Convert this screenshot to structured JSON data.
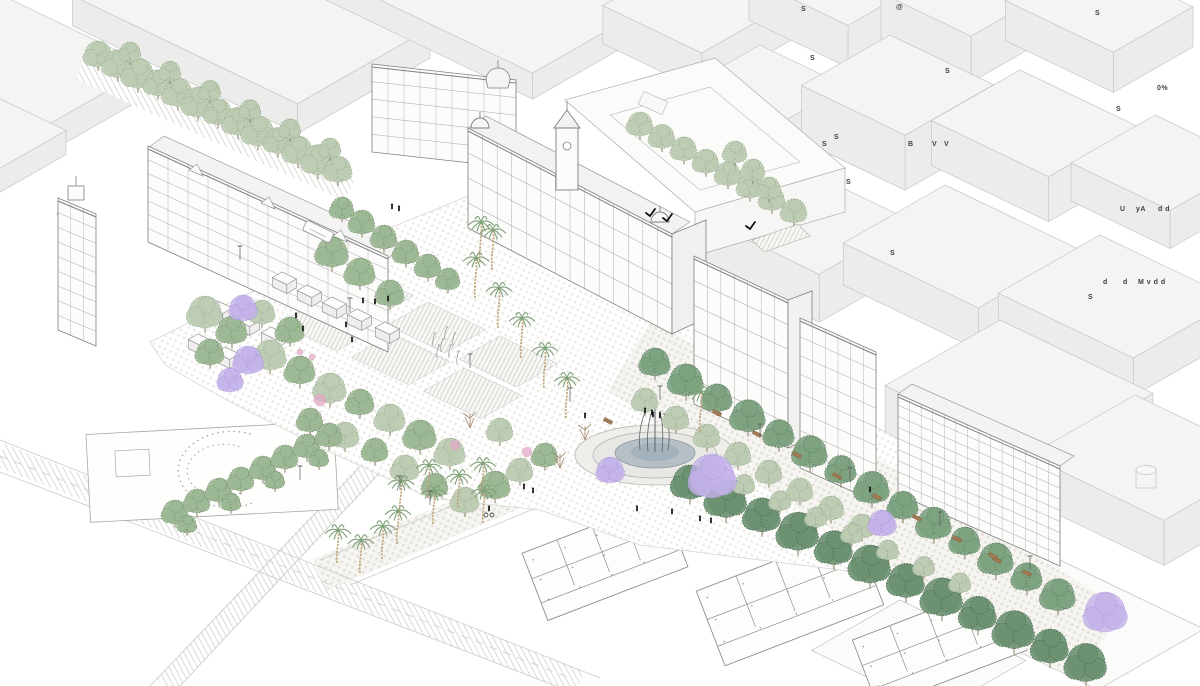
{
  "figure": {
    "kind": "axonometric-urban-plaza-illustration",
    "visible_title": ""
  },
  "palette": {
    "background": "#ffffff",
    "block_fill": "#f4f4f3",
    "block_side": "#ececea",
    "outline_light": "#c7c7c5",
    "outline_faint": "#bfc3bf",
    "line_dark": "#7f7f7f",
    "line_mid": "#9a9a9a",
    "paving": "#edebe6",
    "paving_dark": "#e4e1da",
    "tree_light": "#bccbb2",
    "tree_light_stroke": "#93a989",
    "tree_mid": "#9cb794",
    "tree_mid_stroke": "#748f6d",
    "tree_dark": "#7da27f",
    "tree_dark_stroke": "#55775c",
    "tree_darkest": "#6a9170",
    "tree_darkest_stroke": "#47634d",
    "jacaranda": "#c3b2e8",
    "jacaranda_stroke": "#a48ed9",
    "palm_trunk": "#c0a67c",
    "palm_frond": "#7da077",
    "flower_pink": "#e2aac7",
    "bare_branch": "#a2876b",
    "water": "#b6bfc6",
    "water_dark": "#a3b2bc",
    "fountain_rim": "#8e979e",
    "bench": "#a17a52",
    "figure_black": "#1c1c1c",
    "annotation_color": "#3f3f3f"
  },
  "annotations": [
    {
      "text": "S",
      "x": 801,
      "y": 6
    },
    {
      "text": "@",
      "x": 896,
      "y": 4
    },
    {
      "text": "S",
      "x": 810,
      "y": 55
    },
    {
      "text": "S",
      "x": 945,
      "y": 68
    },
    {
      "text": "S",
      "x": 1095,
      "y": 10
    },
    {
      "text": "0%",
      "x": 1157,
      "y": 85
    },
    {
      "text": "S",
      "x": 1116,
      "y": 106
    },
    {
      "text": "S",
      "x": 834,
      "y": 134
    },
    {
      "text": "S",
      "x": 822,
      "y": 141
    },
    {
      "text": "B",
      "x": 908,
      "y": 141
    },
    {
      "text": "V",
      "x": 932,
      "y": 141
    },
    {
      "text": "V",
      "x": 944,
      "y": 141
    },
    {
      "text": "S",
      "x": 846,
      "y": 179
    },
    {
      "text": "U",
      "x": 1120,
      "y": 206
    },
    {
      "text": "yA",
      "x": 1136,
      "y": 206
    },
    {
      "text": "d d",
      "x": 1158,
      "y": 206
    },
    {
      "text": "d",
      "x": 1103,
      "y": 279
    },
    {
      "text": "d",
      "x": 1123,
      "y": 279
    },
    {
      "text": "M v d d",
      "x": 1138,
      "y": 279
    },
    {
      "text": "S",
      "x": 1088,
      "y": 294
    },
    {
      "text": "S",
      "x": 890,
      "y": 250
    }
  ]
}
